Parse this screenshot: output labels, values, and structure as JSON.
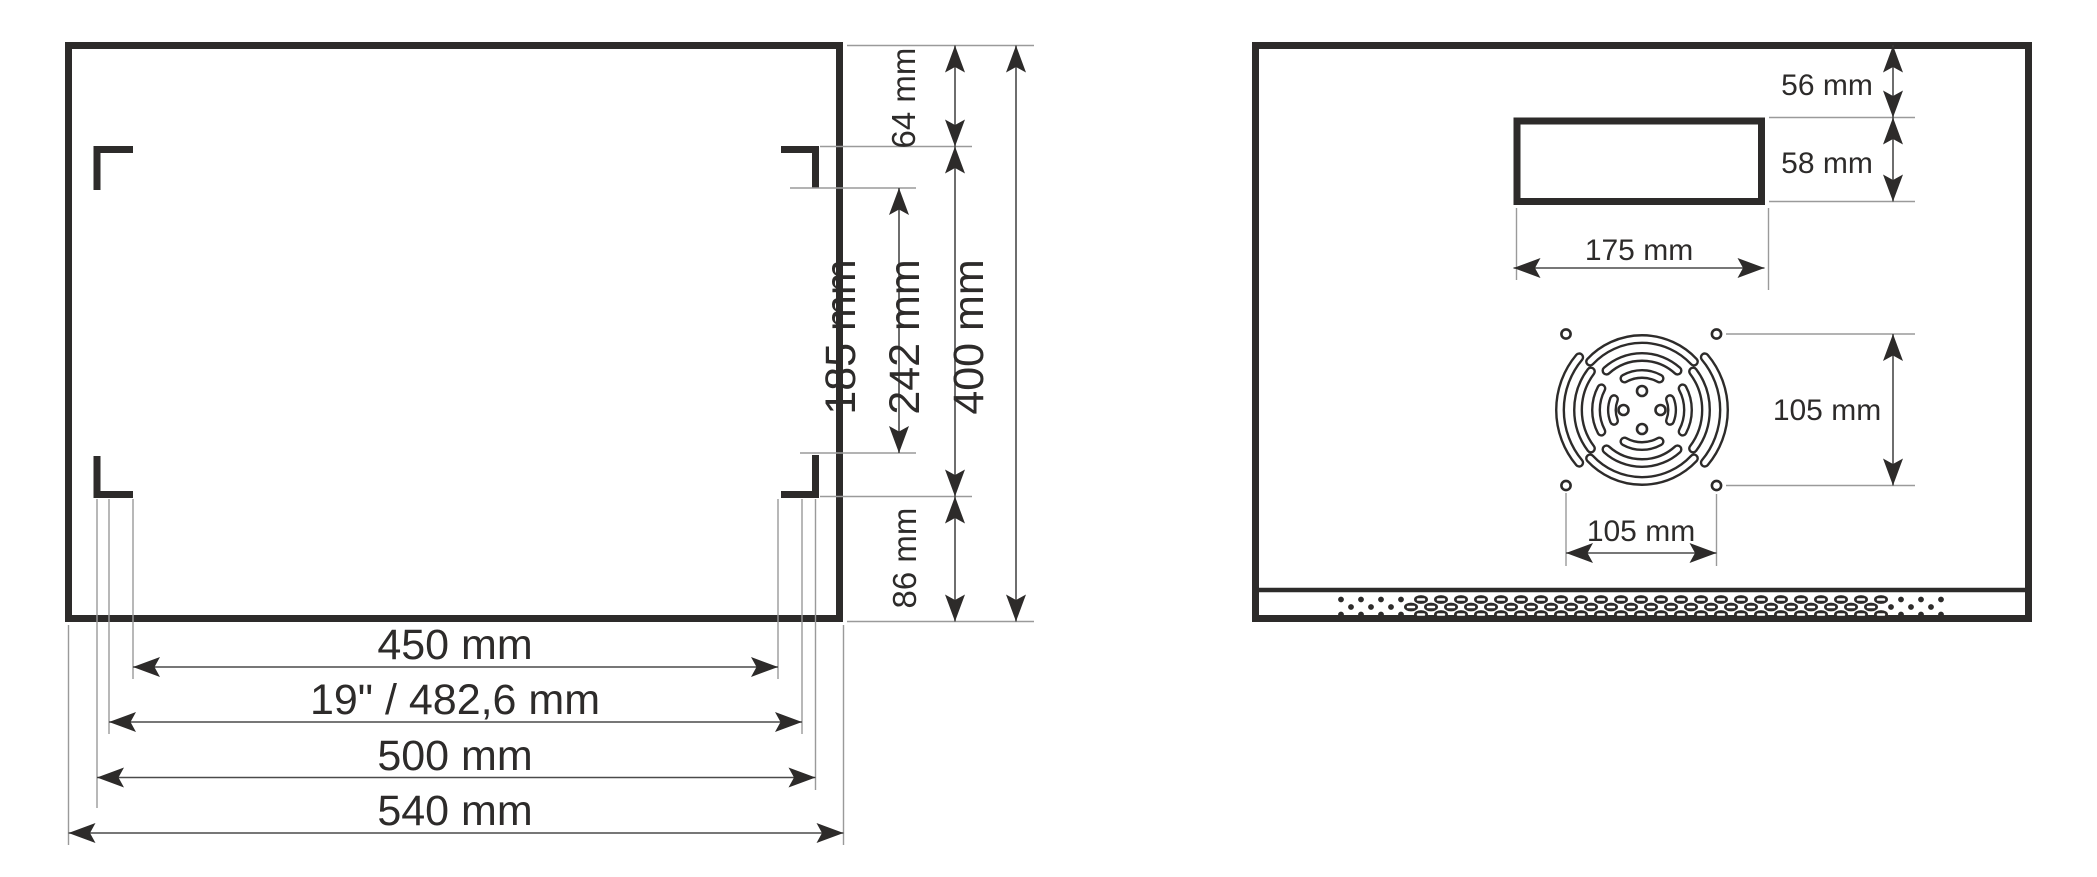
{
  "drawing": {
    "title": "rack-cabinet-dimension-drawing",
    "front_view": {
      "dim_top_offset": "64 mm",
      "dim_rail_opening": "185 mm",
      "dim_rail_span": "242 mm",
      "dim_height": "400 mm",
      "dim_bottom_offset": "86 mm",
      "dim_width_inner": "450 mm",
      "dim_width_rack": "19\" / 482,6 mm",
      "dim_width_mid": "500 mm",
      "dim_width_outer": "540 mm"
    },
    "rear_view": {
      "dim_cutout_top_offset": "56 mm",
      "dim_cutout_height": "58 mm",
      "dim_cutout_width": "175 mm",
      "dim_fan_holes_vertical": "105 mm",
      "dim_fan_holes_horizontal": "105 mm"
    },
    "colors": {
      "outline": "#2d2b2a",
      "dimension_line": "#4a4a4a",
      "extension_line": "#9a9a9a",
      "background": "#ffffff"
    }
  }
}
